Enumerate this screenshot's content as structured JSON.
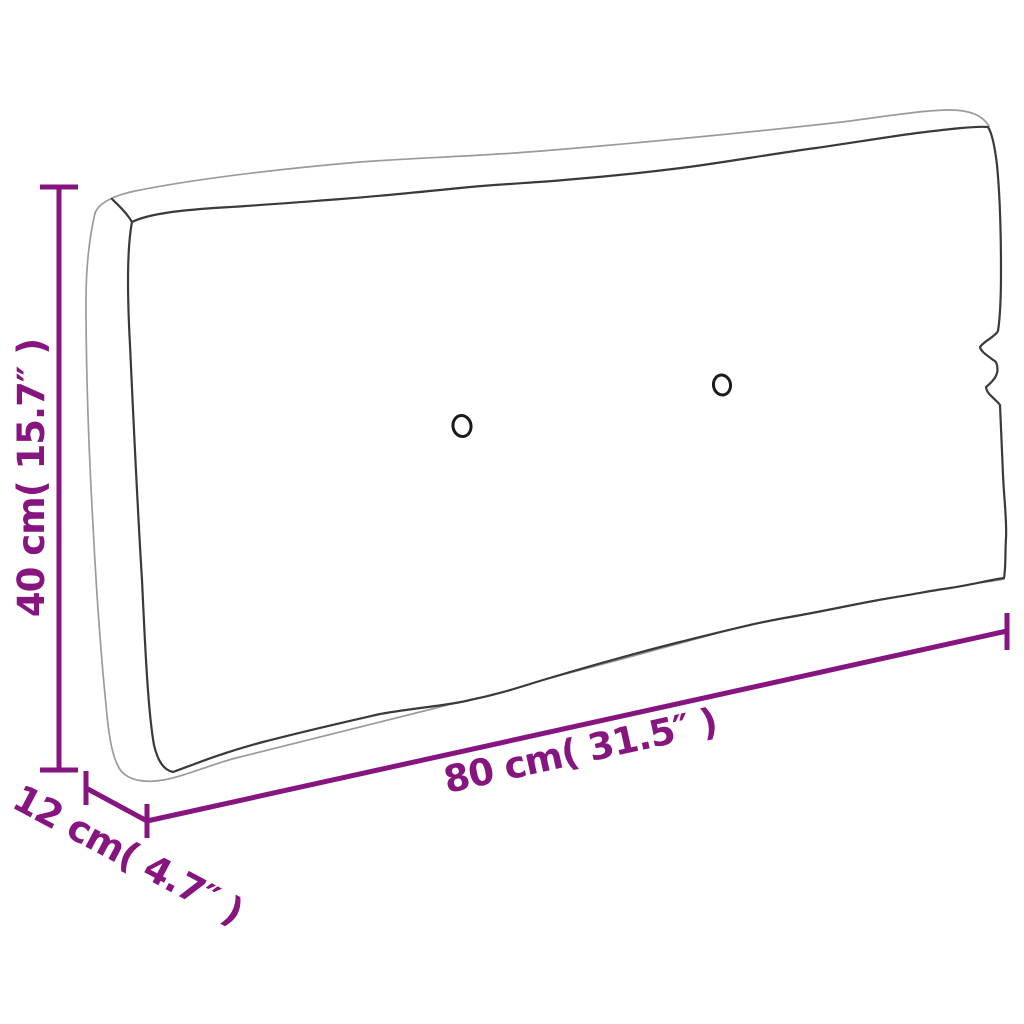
{
  "page": {
    "background_color": "#ffffff"
  },
  "diagram": {
    "subject": "pallet-cushion-outline-drawing",
    "accent_color": "#87157F",
    "outline_color_dark": "#3a3a3a",
    "outline_color_light": "#9b9b9b",
    "button_count": 2,
    "dimensions": {
      "height": {
        "label": "40 cm( 15.7″ )",
        "cm": "40",
        "inches": "15.7"
      },
      "width": {
        "label": "80 cm( 31.5″ )",
        "cm": "80",
        "inches": "31.5"
      },
      "depth": {
        "label": "12 cm( 4.7″ )",
        "cm": "12",
        "inches": "4.7"
      }
    }
  }
}
